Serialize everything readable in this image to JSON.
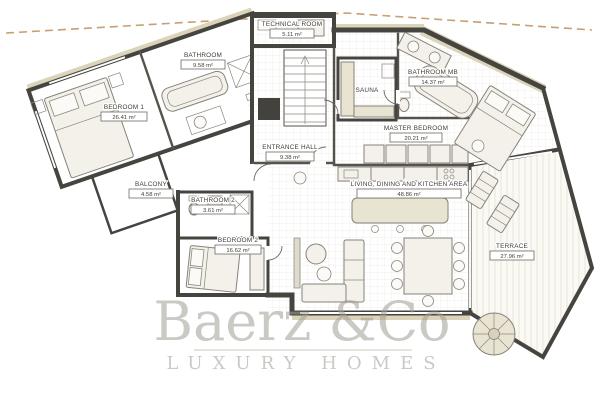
{
  "plan": {
    "title": "villa-floor-plan",
    "rooms": [
      {
        "name": "TECHNICAL ROOM",
        "area": "5.11 m²"
      },
      {
        "name": "BATHROOM",
        "area": "9.58 m²"
      },
      {
        "name": "BEDROOM 1",
        "area": "26.41 m²"
      },
      {
        "name": "BALCONY",
        "area": "4.58 m²"
      },
      {
        "name": "BATHROOM 2",
        "area": "3.61 m²"
      },
      {
        "name": "BEDROOM 2",
        "area": "16.62 m²"
      },
      {
        "name": "ENTRANCE HALL",
        "area": "9.38 m²"
      },
      {
        "name": "SAUNA",
        "area": ""
      },
      {
        "name": "BATHROOM MB",
        "area": "14.37 m²"
      },
      {
        "name": "MASTER BEDROOM",
        "area": "20.21 m²"
      },
      {
        "name": "LIVING, DINING AND KITCHEN AREA",
        "area": "48.86 m²"
      },
      {
        "name": "TERRACE",
        "area": "27.96 m²"
      }
    ],
    "watermark": {
      "brand": "Baerz &Co",
      "tagline": "LUXURY HOMES"
    },
    "colors": {
      "wall": "#45443f",
      "wall_accent_beige": "#dcd4ba",
      "boundary_dash": "#c79f72",
      "watermark_gray": "#a19d93"
    }
  }
}
